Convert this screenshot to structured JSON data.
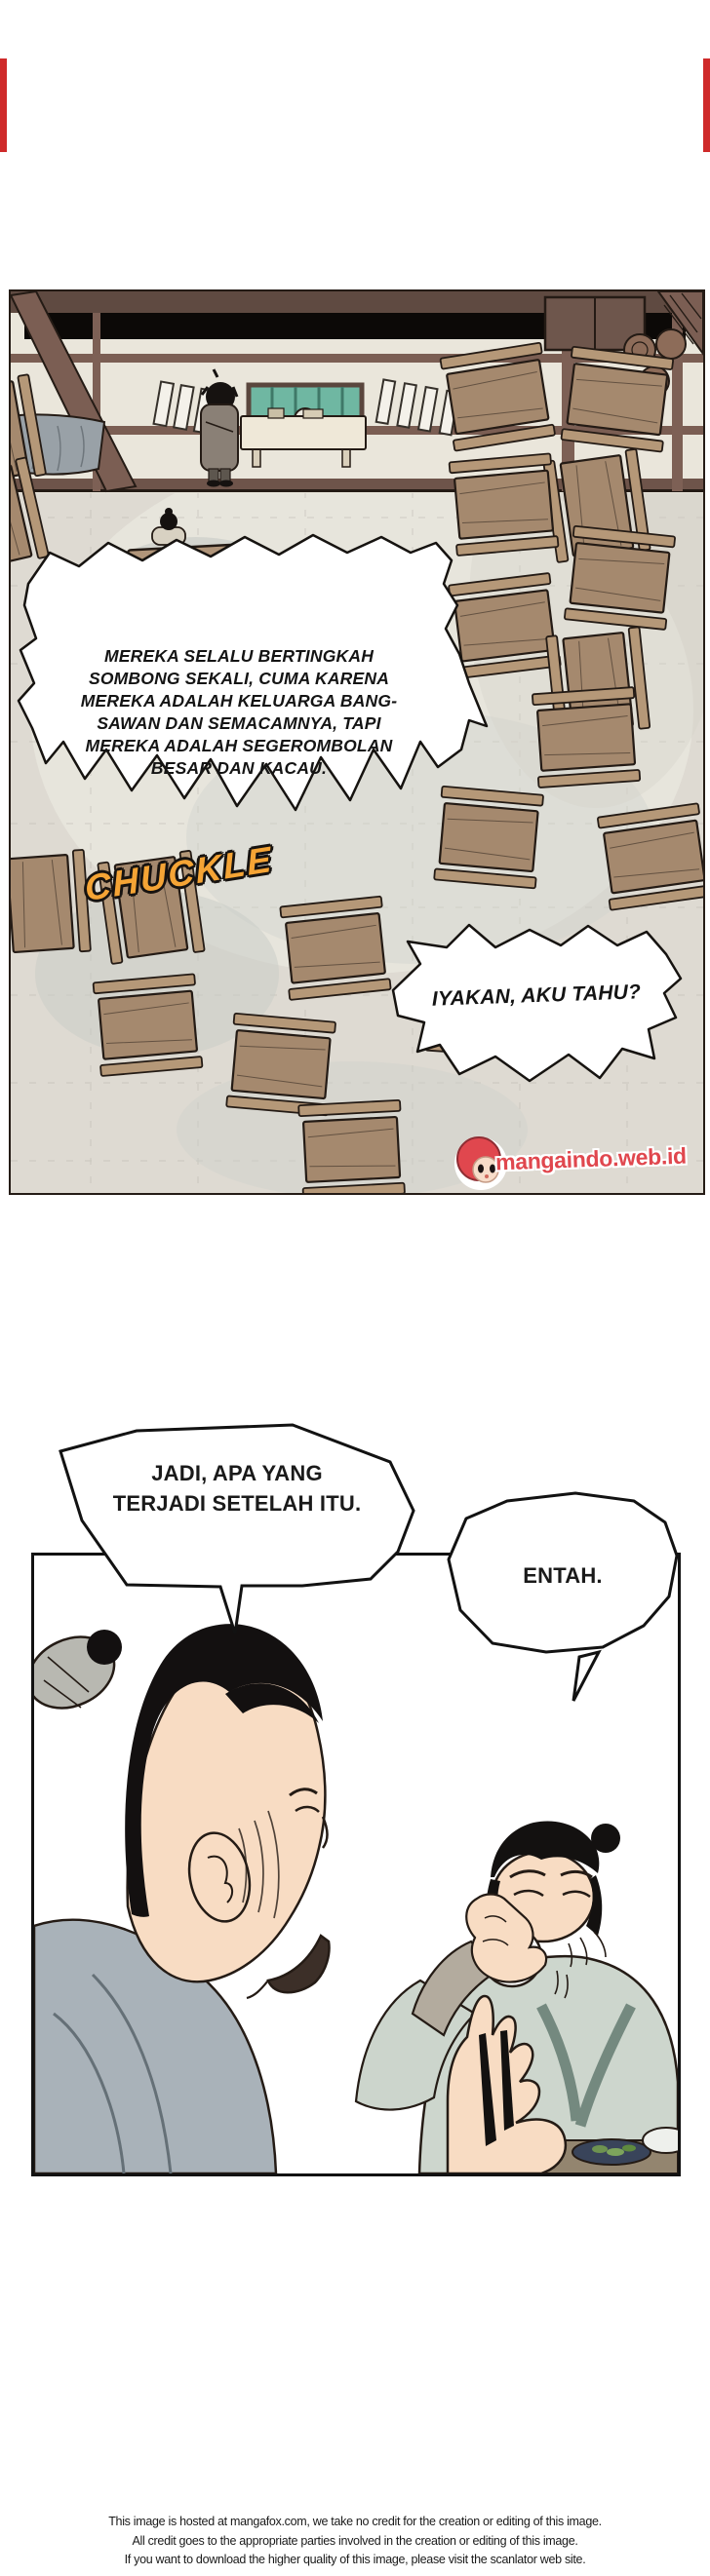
{
  "page": {
    "background": "#ffffff",
    "edge_marker_color": "#cf2a2a"
  },
  "panel1": {
    "scene": "overhead view of a tavern hall with wooden tables and a seated family group",
    "bubble_main": {
      "lines": [
        "MEREKA SELALU BERTINGKAH",
        "SOMBONG SEKALI, CUMA KARENA",
        "MEREKA ADALAH KELUARGA BANG-",
        "SAWAN DAN SEMACAMNYA, TAPI",
        "MEREKA ADALAH SEGEROMBOLAN",
        "BESAR DAN KACAU."
      ]
    },
    "sfx": {
      "text": "CHUCKLE",
      "color": "#f5a435"
    },
    "bubble_reply": {
      "text": "IYAKAN, AKU TAHU?"
    },
    "watermark": {
      "text": "mangaindo.web.id",
      "color": "#e0474e"
    }
  },
  "panel2": {
    "scene": "two men talking, one drinking from a white cup",
    "bubble_question": {
      "lines": [
        "JADI, APA YANG",
        "TERJADI SETELAH ITU."
      ]
    },
    "bubble_answer": {
      "text": "ENTAH."
    }
  },
  "footer": {
    "lines": [
      "This image is hosted at mangafox.com, we take no credit for the creation or editing of this image.",
      "All credit goes to the appropriate parties involved in the creation or editing of this image.",
      "If you want to download the higher quality of this image, please visit the scanlator web site."
    ]
  }
}
